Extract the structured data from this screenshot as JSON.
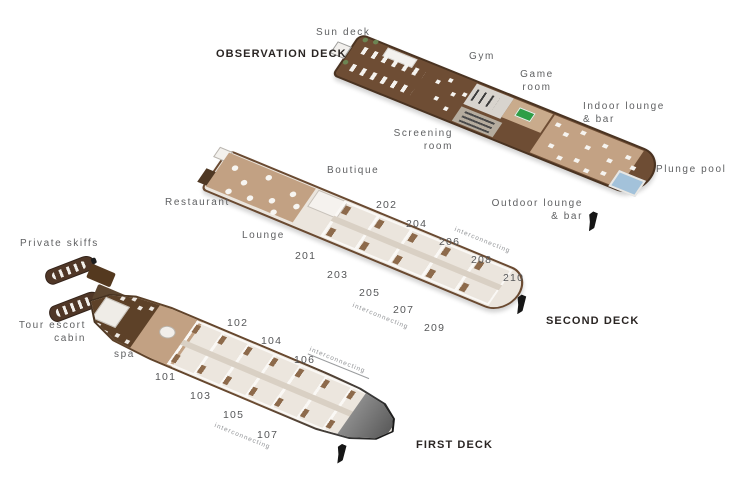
{
  "decks": {
    "observation": {
      "title": "OBSERVATION DECK",
      "labels": {
        "sun_deck": "Sun deck",
        "gym": "Gym",
        "game_room": "Game\nroom",
        "indoor_lounge": "Indoor lounge\n& bar",
        "screening_room": "Screening\nroom",
        "outdoor_lounge": "Outdoor lounge\n& bar",
        "plunge_pool": "Plunge pool"
      }
    },
    "second": {
      "title": "SECOND DECK",
      "labels": {
        "restaurant": "Restaurant",
        "boutique": "Boutique",
        "lounge": "Lounge"
      },
      "cabins": {
        "c201": "201",
        "c202": "202",
        "c203": "203",
        "c204": "204",
        "c205": "205",
        "c206": "206",
        "c207": "207",
        "c208": "208",
        "c209": "209",
        "c210": "210"
      },
      "interconnecting_upper": "interconnecting",
      "interconnecting_lower": "interconnecting"
    },
    "first": {
      "title": "FIRST DECK",
      "labels": {
        "private_skiffs": "Private skiffs",
        "tour_escort_cabin": "Tour escort\ncabin",
        "spa": "spa"
      },
      "cabins": {
        "c101": "101",
        "c102": "102",
        "c103": "103",
        "c104": "104",
        "c105": "105",
        "c106": "106",
        "c107": "107"
      },
      "interconnecting_upper": "interconnecting",
      "interconnecting_lower": "interconnecting"
    }
  },
  "colors": {
    "deck_wood": "#6e4d34",
    "floor_tan": "#c3a284",
    "cabin_cream": "#ece6de",
    "pool_blue": "#a3c2da",
    "pool_table_green": "#2f9e47",
    "hull_dark": "#141414",
    "label_gray": "#5f6062",
    "title_black": "#2a2523"
  }
}
